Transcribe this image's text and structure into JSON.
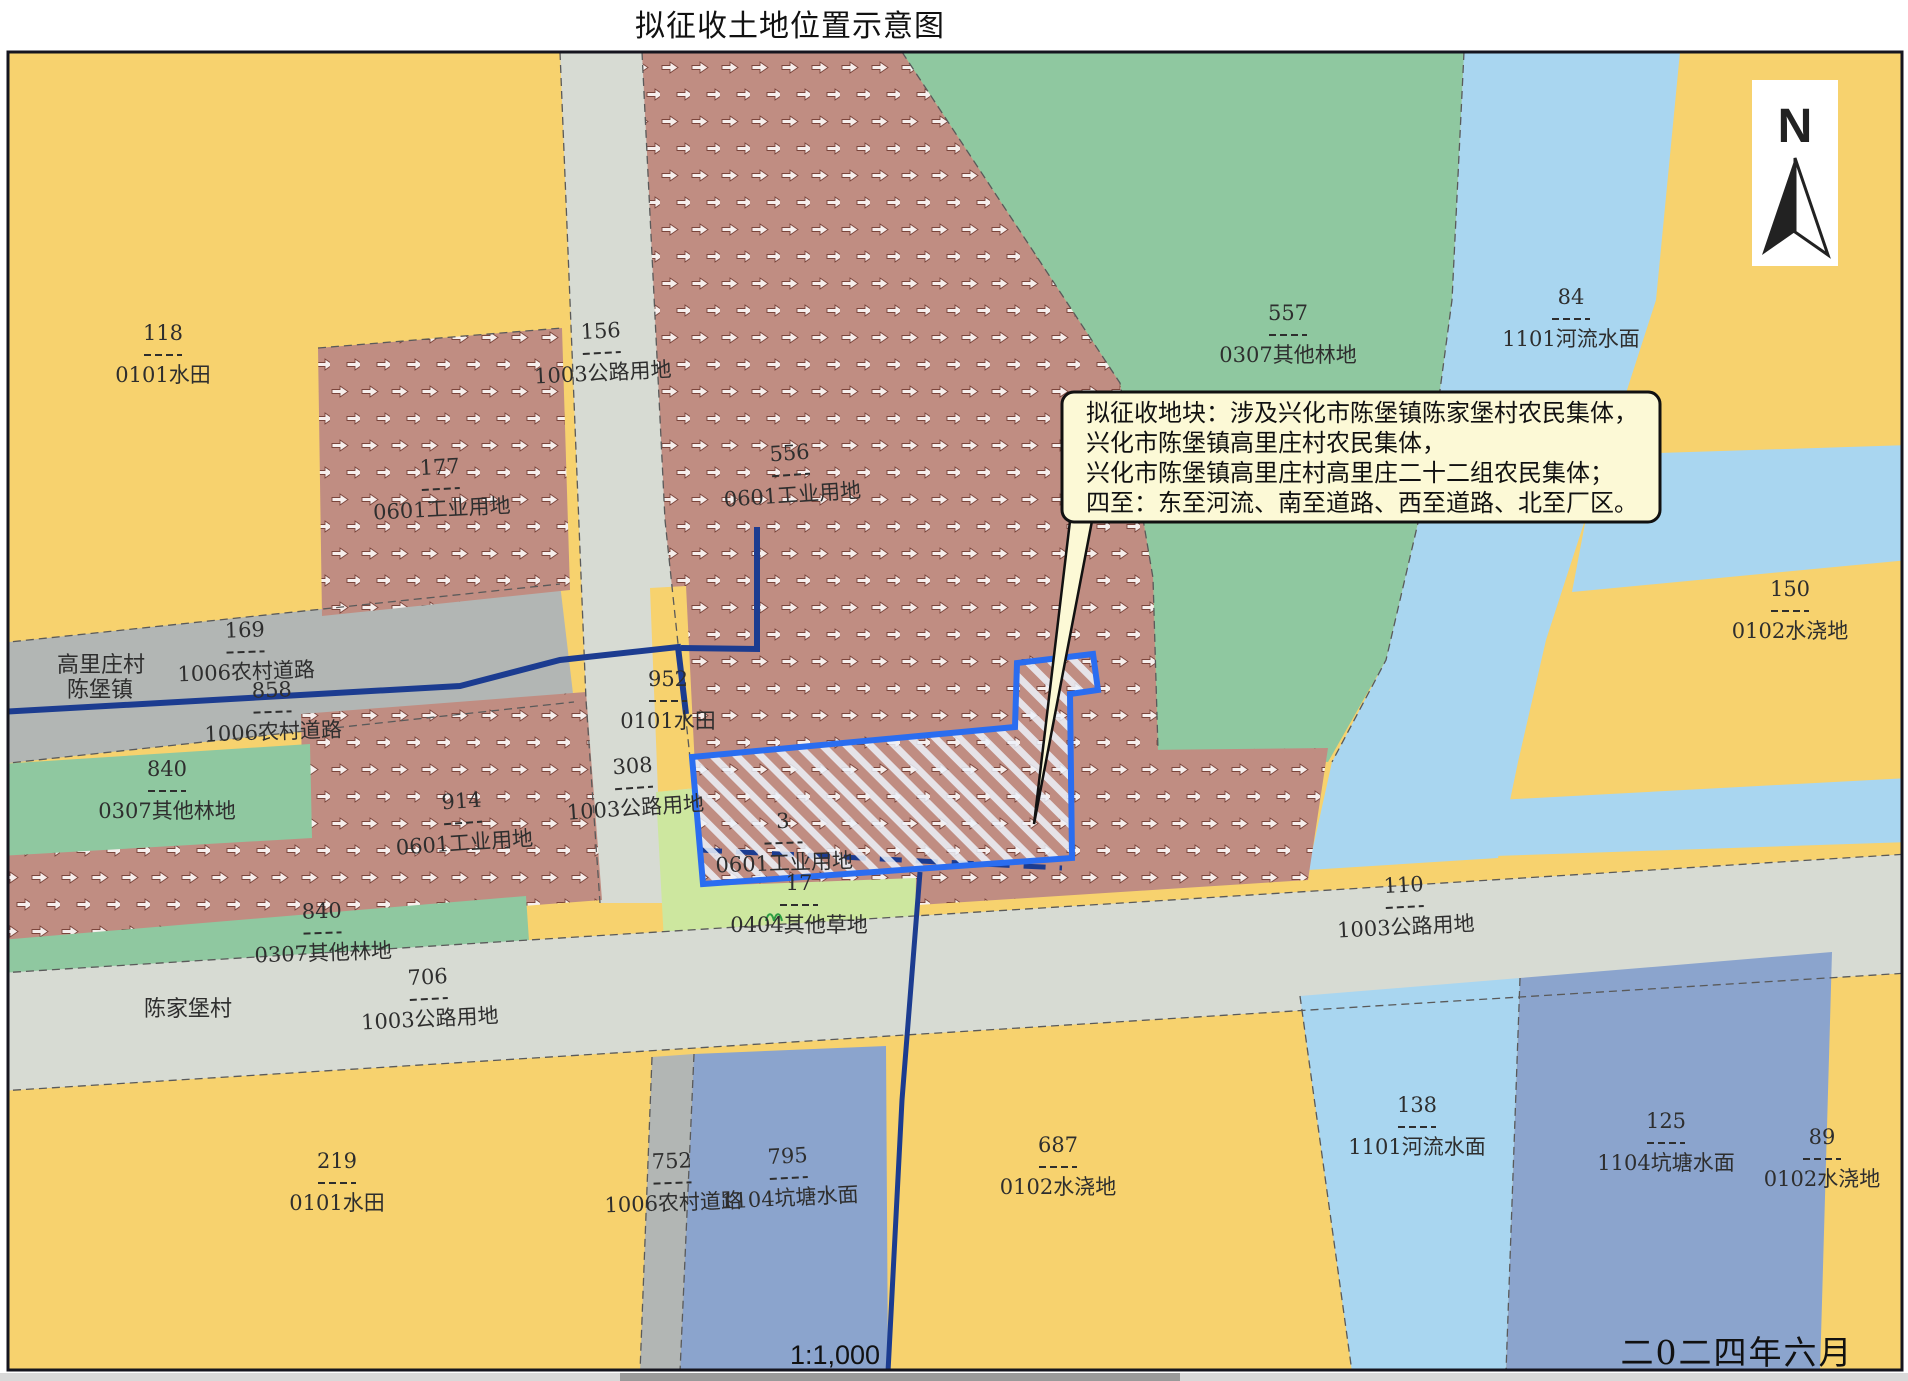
{
  "title": "拟征收土地位置示意图",
  "footer": {
    "scale": "1:1,000",
    "date": "二0二四年六月"
  },
  "north": {
    "label": "N"
  },
  "callout": {
    "lines": [
      "拟征收地块：涉及兴化市陈堡镇陈家堡村农民集体，",
      "兴化市陈堡镇高里庄村农民集体，",
      "兴化市陈堡镇高里庄村高里庄二十二组农民集体；",
      "四至：东至河流、南至道路、西至道路、北至厂区。"
    ]
  },
  "colors": {
    "paddy": "#f7d26e",
    "industrial": "#c08d82",
    "road": "#d7dbd3",
    "rural_road": "#b2b6b4",
    "forest": "#8fc8a0",
    "river": "#a9d6f0",
    "pond": "#8ba4cd",
    "grass": "#cde79f",
    "hatch": "#edf2fa",
    "parcel_outline": "#2a6df0",
    "navy": "#1c3c90",
    "ink": "#2e2e2e",
    "callout_bg": "#fcf9d6"
  },
  "map": {
    "labels": [
      {
        "num": "118",
        "name": "0101水田",
        "x": 163,
        "y": 340,
        "rot": 0
      },
      {
        "num": "156",
        "name": "1003公路用地",
        "x": 601,
        "y": 338,
        "rot": -3
      },
      {
        "num": "177",
        "name": "0601工业用地",
        "x": 440,
        "y": 474,
        "rot": -3
      },
      {
        "num": "556",
        "name": "0601工业用地",
        "x": 790,
        "y": 460,
        "rot": -4
      },
      {
        "num": "557",
        "name": "0307其他林地",
        "x": 1288,
        "y": 320,
        "rot": 0
      },
      {
        "num": "84",
        "name": "1101河流水面",
        "x": 1571,
        "y": 304,
        "rot": 0
      },
      {
        "num": "150",
        "name": "0102水浇地",
        "x": 1790,
        "y": 596,
        "rot": 0
      },
      {
        "num": "169",
        "name": "1006农村道路",
        "x": 245,
        "y": 637,
        "rot": -2
      },
      {
        "num": "858",
        "name": "1006农村道路",
        "x": 272,
        "y": 697,
        "rot": -2
      },
      {
        "num": "840",
        "name": "0307其他林地",
        "x": 167,
        "y": 776,
        "rot": 0
      },
      {
        "num": "952",
        "name": "0101水田",
        "x": 668,
        "y": 686,
        "rot": 0
      },
      {
        "num": "308",
        "name": "1003公路用地",
        "x": 633,
        "y": 773,
        "rot": -4
      },
      {
        "num": "914",
        "name": "0601工业用地",
        "x": 462,
        "y": 808,
        "rot": -4
      },
      {
        "num": "3",
        "name": "0601工业用地",
        "x": 783,
        "y": 828,
        "rot": -2
      },
      {
        "num": "17",
        "name": "0404其他草地",
        "x": 799,
        "y": 890,
        "rot": 0
      },
      {
        "num": "840",
        "name": "0307其他林地",
        "x": 322,
        "y": 918,
        "rot": -2
      },
      {
        "num": "706",
        "name": "1003公路用地",
        "x": 428,
        "y": 984,
        "rot": -3
      },
      {
        "num": "110",
        "name": "1003公路用地",
        "x": 1404,
        "y": 892,
        "rot": -3
      },
      {
        "num": "219",
        "name": "0101水田",
        "x": 337,
        "y": 1168,
        "rot": 0
      },
      {
        "num": "752",
        "name": "1006农村道路",
        "x": 672,
        "y": 1168,
        "rot": -2
      },
      {
        "num": "795",
        "name": "1104坑塘水面",
        "x": 788,
        "y": 1163,
        "rot": -3
      },
      {
        "num": "687",
        "name": "0102水浇地",
        "x": 1058,
        "y": 1152,
        "rot": 0
      },
      {
        "num": "138",
        "name": "1101河流水面",
        "x": 1417,
        "y": 1112,
        "rot": 0
      },
      {
        "num": "125",
        "name": "1104坑塘水面",
        "x": 1666,
        "y": 1128,
        "rot": 0
      },
      {
        "num": "89",
        "name": "0102水浇地",
        "x": 1822,
        "y": 1144,
        "rot": 0
      }
    ],
    "villages": [
      {
        "text": "高里庄村",
        "x": 101,
        "y": 672,
        "color": "#ff00ff"
      },
      {
        "text": "陈堡镇",
        "x": 100,
        "y": 697,
        "color": "#2db14d"
      },
      {
        "text": "陈家堡村",
        "x": 188,
        "y": 1016,
        "color": "#ff00ff"
      }
    ]
  }
}
